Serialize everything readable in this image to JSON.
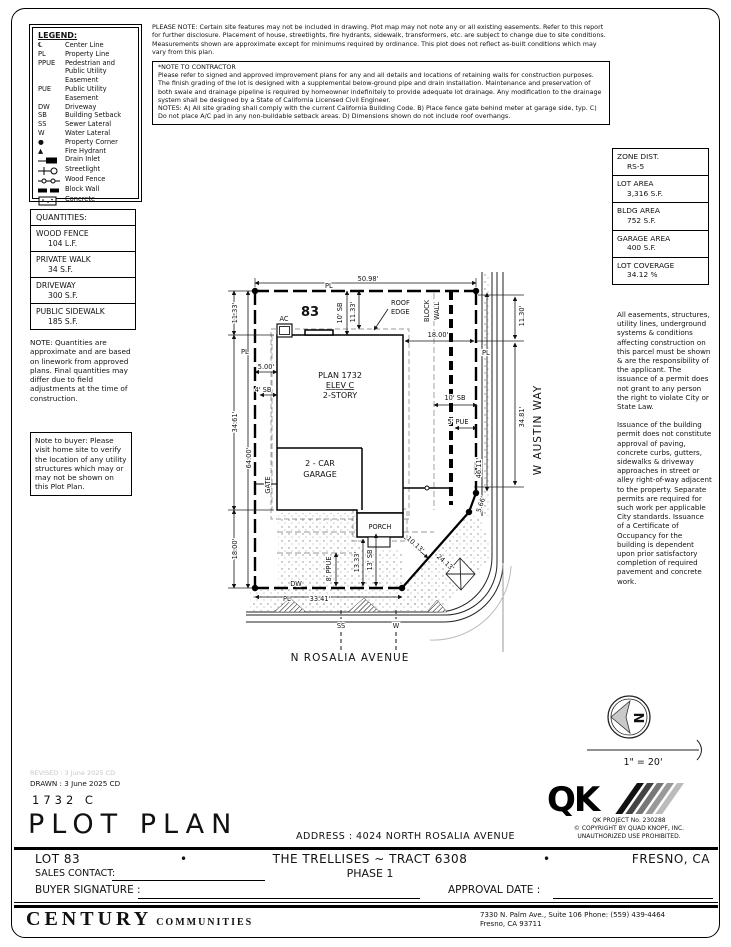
{
  "legend": {
    "title": "LEGEND:",
    "items": [
      {
        "sym": "℄",
        "label": "Center Line"
      },
      {
        "sym": "PL",
        "label": "Property Line"
      },
      {
        "sym": "PPUE",
        "label": "Pedestrian and Public Utility Easement"
      },
      {
        "sym": "PUE",
        "label": "Public Utility Easement"
      },
      {
        "sym": "DW",
        "label": "Driveway"
      },
      {
        "sym": "SB",
        "label": "Building Setback"
      },
      {
        "sym": "SS",
        "label": "Sewer Lateral"
      },
      {
        "sym": "W",
        "label": "Water Lateral"
      },
      {
        "sym": "●",
        "label": "Property Corner"
      },
      {
        "sym": "▲",
        "label": "Fire Hydrant"
      },
      {
        "sym": "",
        "icon": "drain-inlet-icon",
        "label": "Drain Inlet"
      },
      {
        "sym": "",
        "icon": "streetlight-icon",
        "label": "Streetlight"
      },
      {
        "sym": "",
        "icon": "wood-fence-icon",
        "label": "Wood Fence"
      },
      {
        "sym": "",
        "icon": "block-wall-icon",
        "label": "Block Wall"
      },
      {
        "sym": "",
        "icon": "concrete-icon",
        "label": "Concrete"
      }
    ]
  },
  "notes": {
    "please_note": "PLEASE NOTE:  Certain site features may not be included in drawing.  Plot map may not note any or all existing easements. Refer to this report for further disclosure.  Placement of house, streetlights, fire hydrants, sidewalk, transformers, etc. are subject to change due to site conditions.  Measurements shown are approximate except for minimums required by ordinance.  This plot does not reflect as-built conditions which may vary from this plan.",
    "contractor_title": "*NOTE TO CONTRACTOR",
    "contractor_body": "Please refer to signed and approved improvement plans for any and all details and locations of retaining walls for construction purposes.  The finish grading of the lot is designed with a supplemental below-ground pipe and drain installation.  Maintenance and preservation of both swale and drainage pipeline is required by homeowner indefinitely to provide adequate lot drainage.  Any modification to the drainage system shall be designed by a State of California Licensed Civil Engineer.",
    "contractor_notes": "NOTES:  A) All site grading shall comply with the current California Building Code.  B) Place fence gate behind meter at garage side, typ.  C) Do not place A/C pad in any non-buildable setback areas.  D) Dimensions shown do not include roof overhangs."
  },
  "qty": {
    "title": "QUANTITIES:",
    "rows": [
      {
        "name": "WOOD FENCE",
        "value": "104 L.F."
      },
      {
        "name": "PRIVATE WALK",
        "value": "34 S.F."
      },
      {
        "name": "DRIVEWAY",
        "value": "300 S.F."
      },
      {
        "name": "PUBLIC SIDEWALK",
        "value": "185 S.F."
      }
    ],
    "note": "NOTE: Quantities are approximate and are based on linework from approved plans.  Final quantities may differ due to field adjustments at the time of construction.",
    "buyer_note": "Note to buyer: Please visit home site to verify the location of any utility structures which may or may not be shown on this Plot Plan."
  },
  "zone": {
    "rows": [
      {
        "name": "ZONE DIST.",
        "value": "RS-5"
      },
      {
        "name": "LOT AREA",
        "value": "3,316 S.F."
      },
      {
        "name": "BLDG AREA",
        "value": "752 S.F."
      },
      {
        "name": "GARAGE AREA",
        "value": "400 S.F."
      },
      {
        "name": "LOT COVERAGE",
        "value": "34.12 %"
      }
    ]
  },
  "rnotes": {
    "para1": "All easements, structures, utility lines, underground systems & conditions affecting construction on this parcel must be shown & are the responsibility of the applicant. The issuance of a permit does not grant to any person the right to violate City or State Law.",
    "para2": "Issuance of the building permit does not constitute approval of paving, concrete curbs, gutters, sidewalks & driveway approaches in street or alley right-of-way adjacent to the property. Separate permits are required for such work per applicable City standards. Issuance of a Certificate of Occupancy for the building is dependent upon prior satisfactory completion of required pavement and concrete work."
  },
  "p": {
    "pl": "PL",
    "d5098": "50.98'",
    "lot83": "83",
    "sb10t": "10' SB",
    "d1133t": "11.33'",
    "roof1": "ROOF",
    "roof2": "EDGE",
    "ac": "AC",
    "blk1": "BLOCK",
    "blk2": "WALL",
    "d1800r": "18.00'",
    "plan1": "PLAN 1732",
    "plan2": "ELEV C",
    "plan3": "2-STORY",
    "d500": "5.00'",
    "sb4": "4' SB",
    "d1133l": "11.33'",
    "d3461": "34.61'",
    "d6400": "64.00'",
    "gate": "GATE",
    "d1800l": "18.00'",
    "gar1": "2 - CAR",
    "gar2": "GARAGE",
    "sb10r": "10' SB",
    "pue5": "5' PUE",
    "d1130": "11.30'",
    "d3481": "34.81'",
    "austin": "W AUSTIN WAY",
    "d4611": "46.11'",
    "d566": "5.66'",
    "d1013": "10.13'",
    "d2413": "24.13'",
    "porch": "PORCH",
    "d1333": "13.33'",
    "sb13": "13' SB",
    "ppue8": "8' PPUE",
    "dw": "DW",
    "d3341": "33.41'",
    "ss": "SS",
    "w": "W",
    "rosalia": "N ROSALIA AVENUE"
  },
  "cmp": {
    "n": "N",
    "scale": "1\" = 20'"
  },
  "tb": {
    "revised": "REVISED : 3 June 2025  CD",
    "drawn": "DRAWN :  3 June 2025  CD",
    "code": "1732  C",
    "title": "PLOT PLAN",
    "address": "ADDRESS :  4024 NORTH ROSALIA AVENUE",
    "qk": "QK",
    "qk1": "QK PROJECT No. 230288",
    "qk2": "©  COPYRIGHT BY QUAD KNOPF, INC.",
    "qk3": "UNAUTHORIZED USE PROHIBITED.",
    "lot": "LOT 83",
    "b1": "•",
    "b2": "•",
    "tract": "THE TRELLISES ~ TRACT 6308",
    "phase": "PHASE 1",
    "city": "FRESNO, CA",
    "sales": "SALES CONTACT:",
    "sign": "BUYER SIGNATURE :",
    "approval": "APPROVAL DATE :",
    "brand1": "CENTURY",
    "brand2": "COMMUNITIES",
    "addr1": "7330 N. Palm Ave., Suite 106    Phone:  (559) 439-4464",
    "addr2": "Fresno, CA  93711"
  }
}
